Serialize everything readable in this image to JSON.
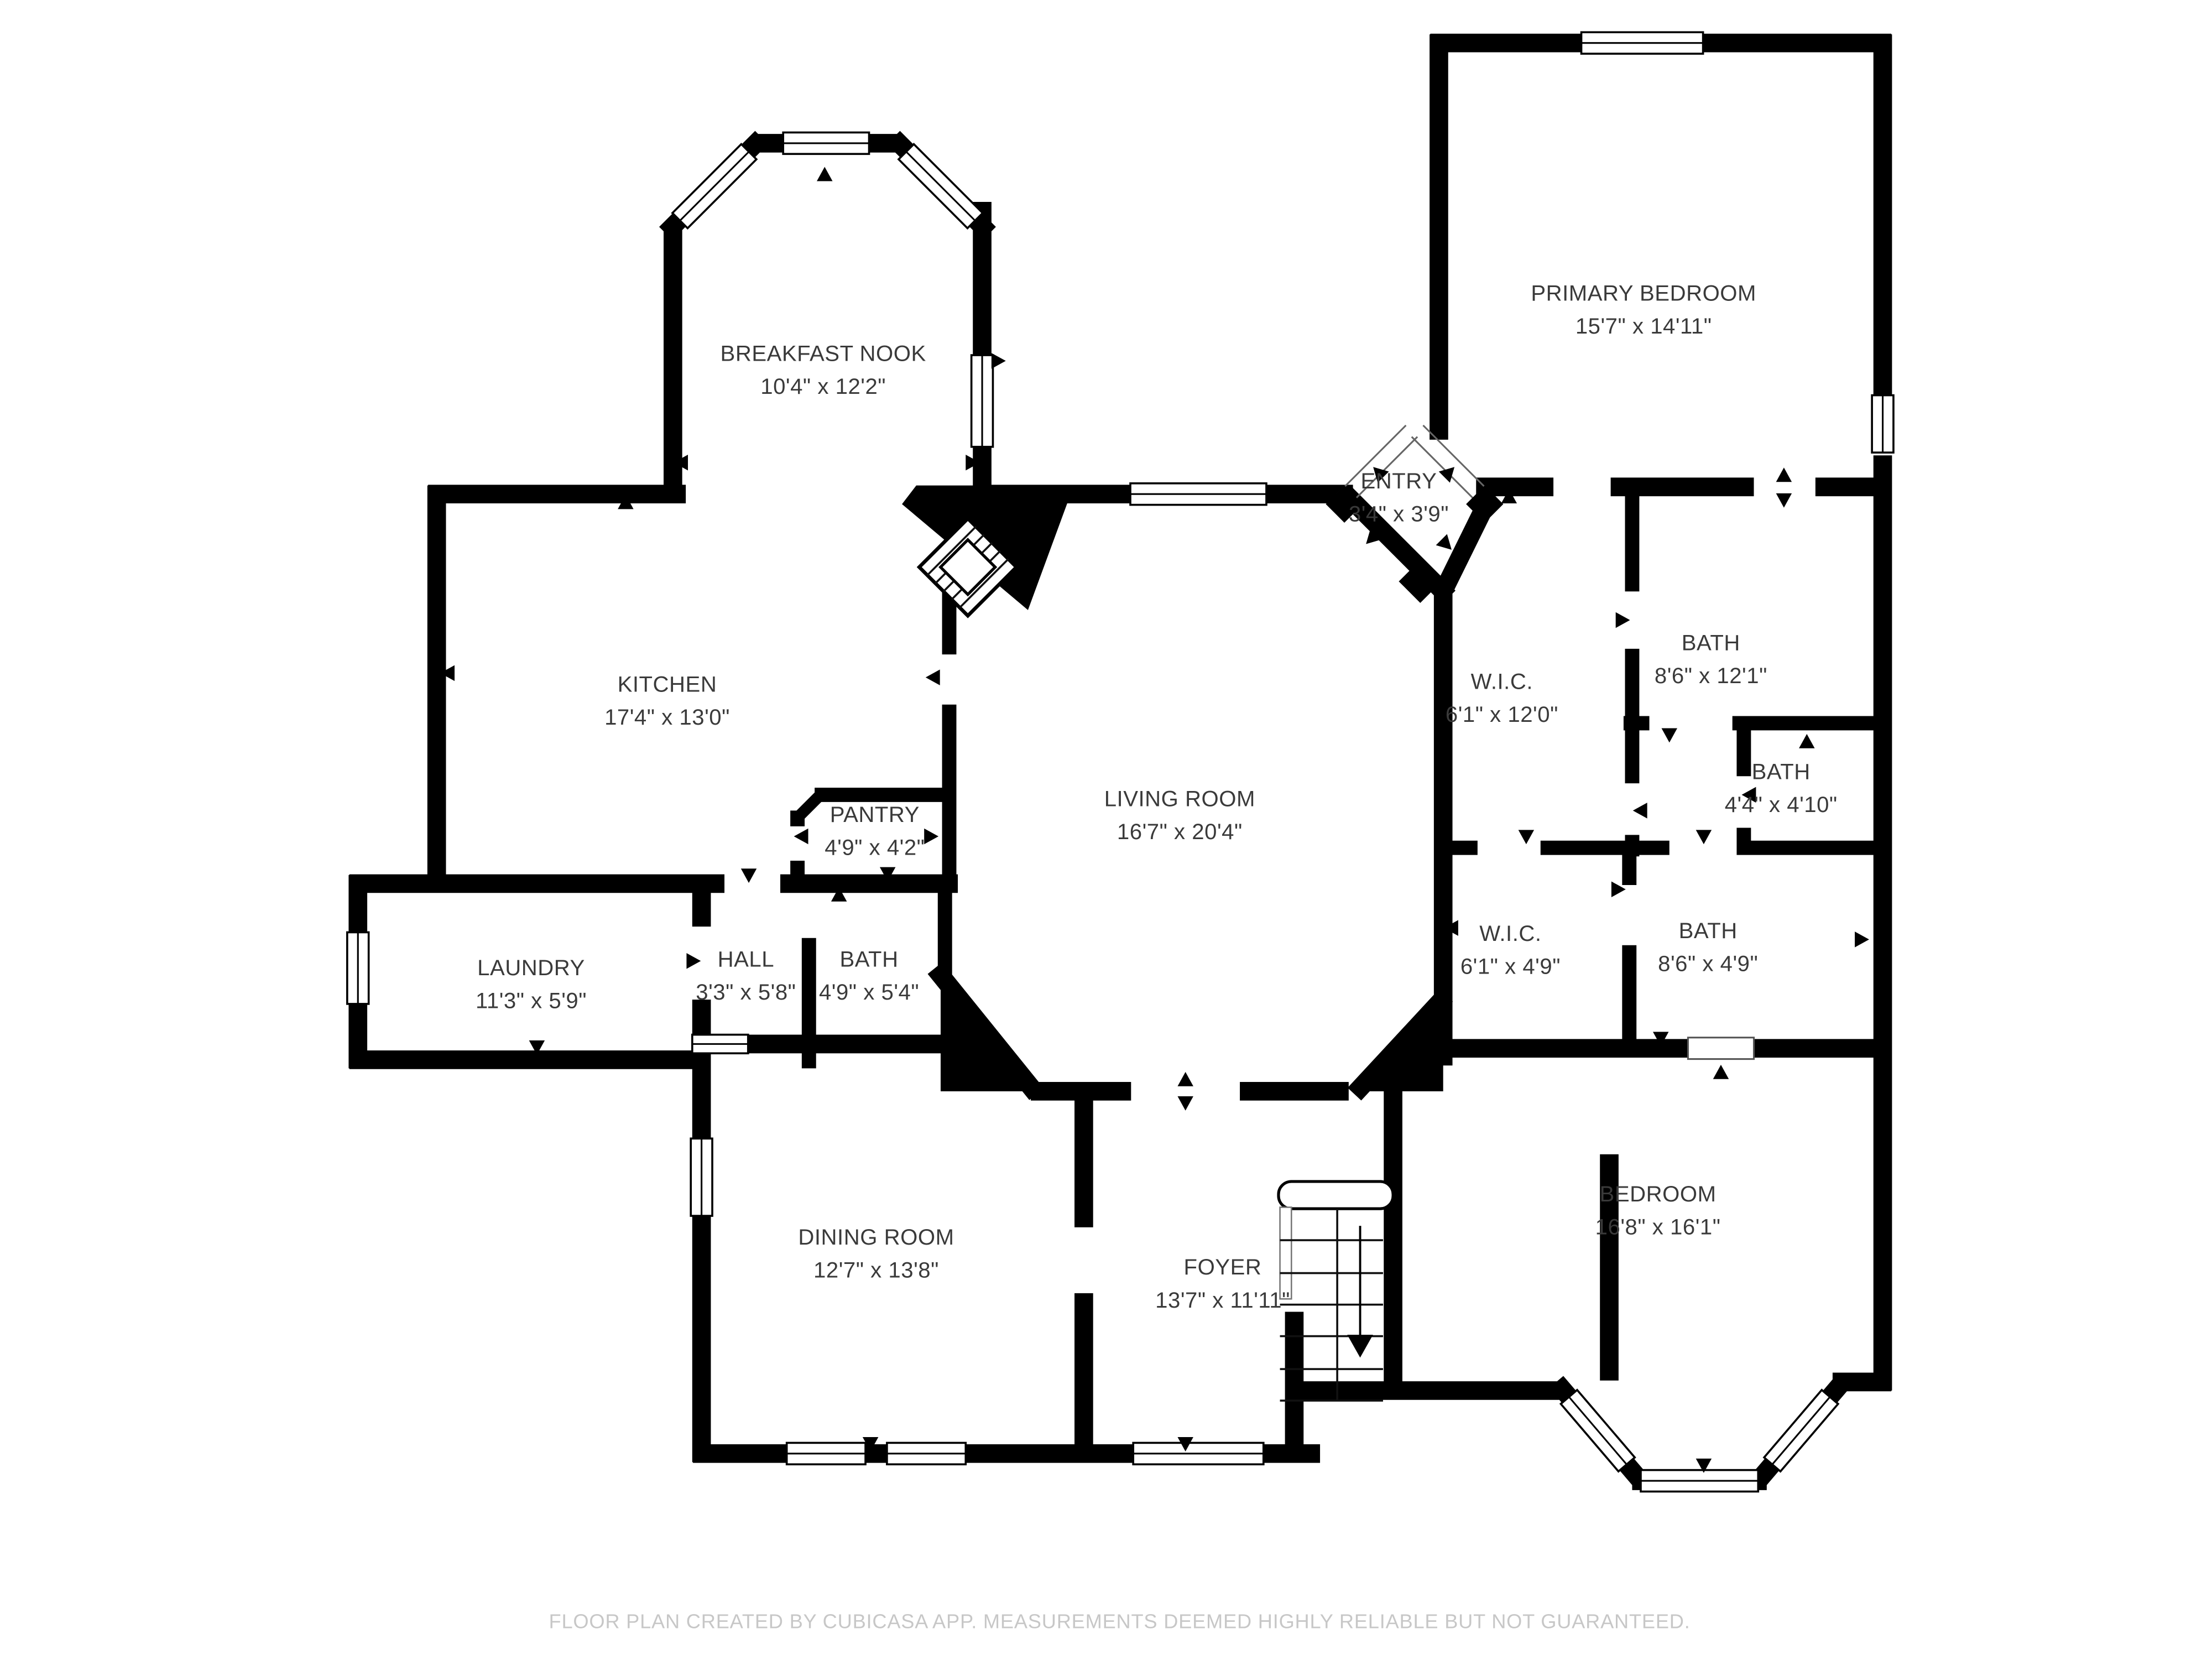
{
  "rooms": [
    {
      "id": "breakfast-nook",
      "name": "BREAKFAST NOOK",
      "dims": "10'4\" x 12'2\""
    },
    {
      "id": "kitchen",
      "name": "KITCHEN",
      "dims": "17'4\" x 13'0\""
    },
    {
      "id": "pantry",
      "name": "PANTRY",
      "dims": "4'9\" x 4'2\""
    },
    {
      "id": "laundry",
      "name": "LAUNDRY",
      "dims": "11'3\" x 5'9\""
    },
    {
      "id": "hall",
      "name": "HALL",
      "dims": "3'3\" x 5'8\""
    },
    {
      "id": "bath-hall",
      "name": "BATH",
      "dims": "4'9\" x 5'4\""
    },
    {
      "id": "living-room",
      "name": "LIVING ROOM",
      "dims": "16'7\" x 20'4\""
    },
    {
      "id": "entry",
      "name": "ENTRY",
      "dims": "3'4\" x 3'9\""
    },
    {
      "id": "primary-bedroom",
      "name": "PRIMARY BEDROOM",
      "dims": "15'7\" x 14'11\""
    },
    {
      "id": "bath-primary",
      "name": "BATH",
      "dims": "8'6\" x 12'1\""
    },
    {
      "id": "wic-upper",
      "name": "W.I.C.",
      "dims": "6'1\" x 12'0\""
    },
    {
      "id": "bath-small",
      "name": "BATH",
      "dims": "4'4\" x 4'10\""
    },
    {
      "id": "wic-lower",
      "name": "W.I.C.",
      "dims": "6'1\" x 4'9\""
    },
    {
      "id": "bath-lower",
      "name": "BATH",
      "dims": "8'6\" x 4'9\""
    },
    {
      "id": "dining-room",
      "name": "DINING ROOM",
      "dims": "12'7\" x 13'8\""
    },
    {
      "id": "foyer",
      "name": "FOYER",
      "dims": "13'7\" x 11'11\""
    },
    {
      "id": "bedroom",
      "name": "BEDROOM",
      "dims": "16'8\" x 16'1\""
    }
  ],
  "footer": {
    "disclaimer": "FLOOR PLAN CREATED BY CUBICASA APP. MEASUREMENTS DEEMED HIGHLY RELIABLE BUT NOT GUARANTEED."
  },
  "colors": {
    "wall": "#000000",
    "label": "#3a3a3a",
    "footer": "#c7c7c7",
    "background": "#ffffff"
  }
}
